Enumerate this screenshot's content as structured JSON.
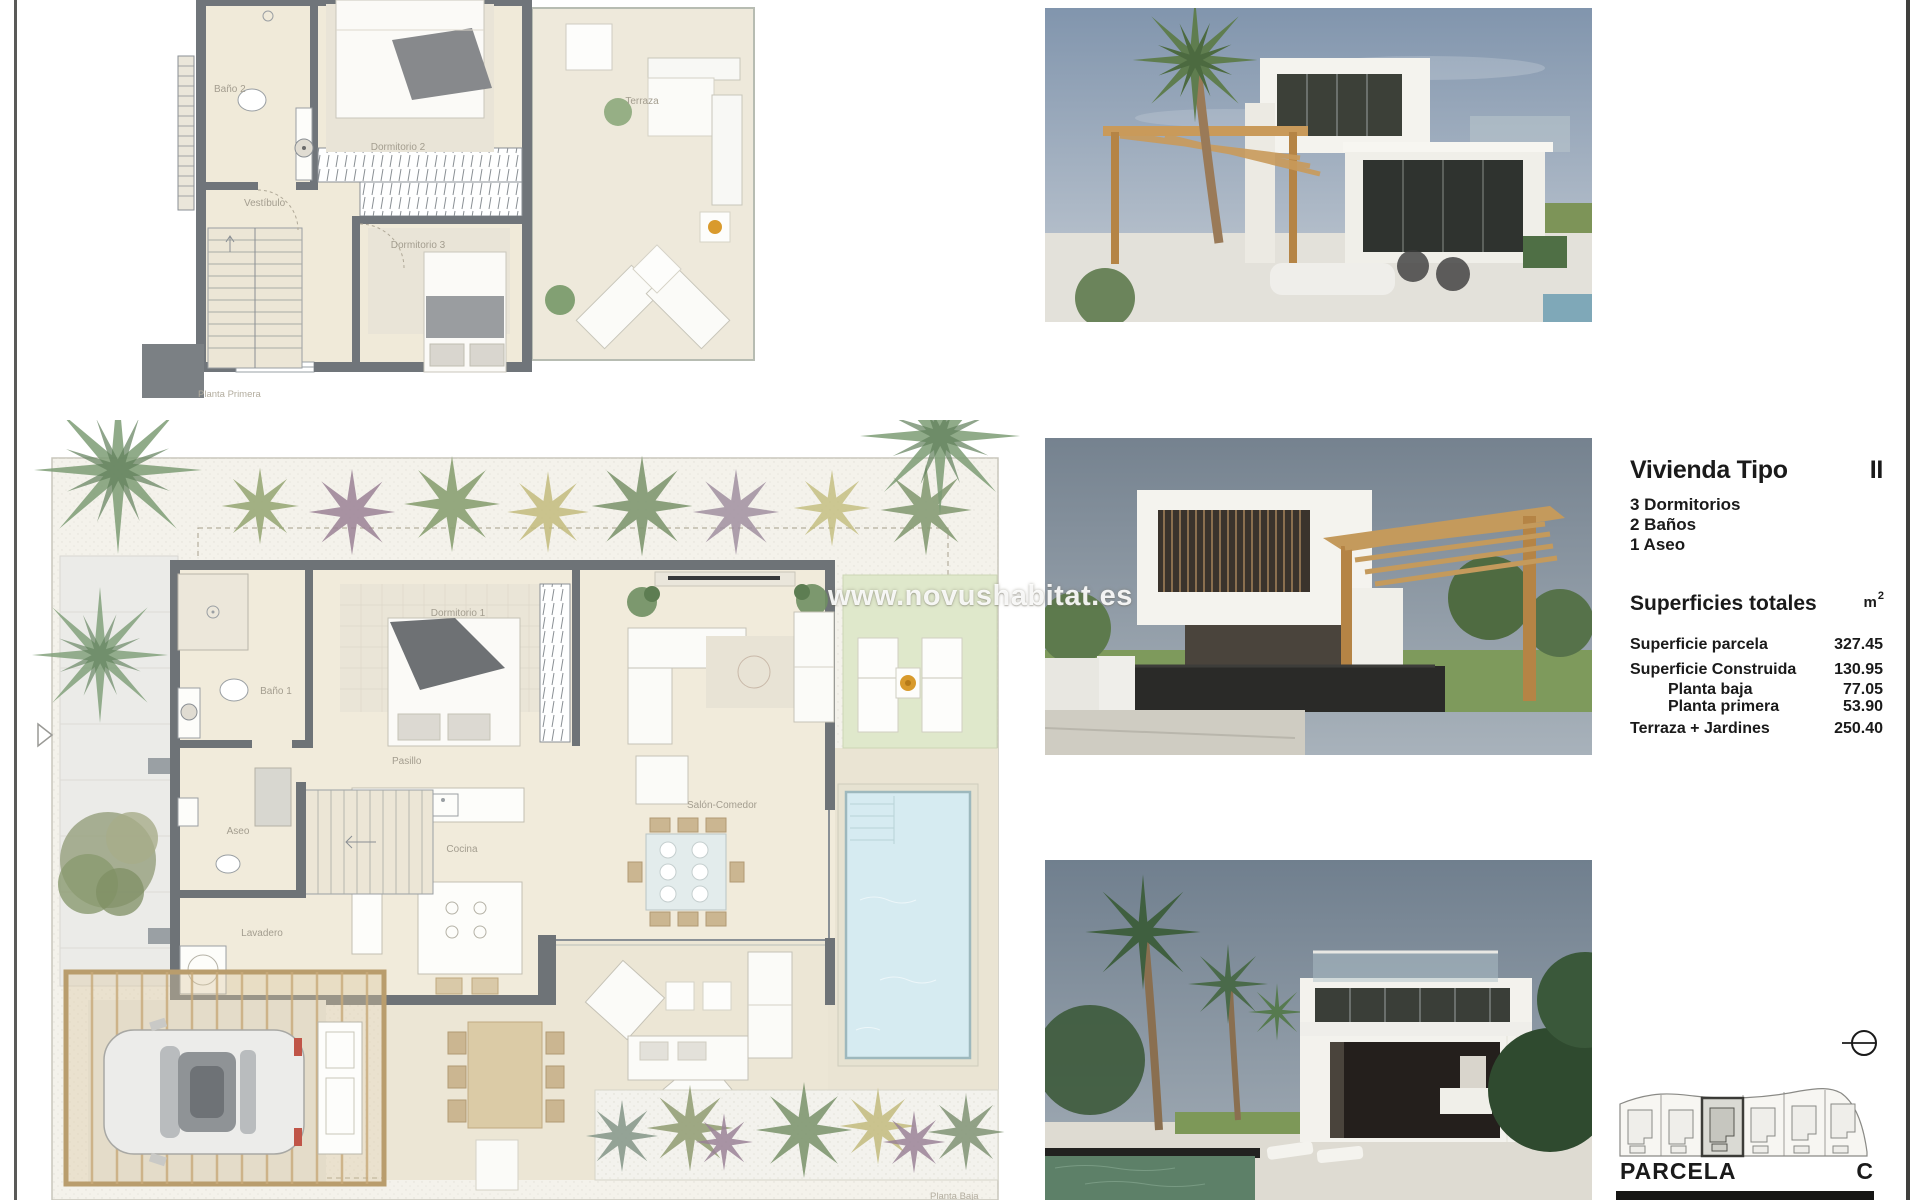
{
  "watermark": "www.novushabitat.es",
  "plan_first": {
    "caption": "Planta Primera",
    "rooms": {
      "bano2": "Baño 2",
      "dorm2": "Dormitorio 2",
      "vestibulo": "Vestíbulo",
      "dorm3": "Dormitorio 3",
      "terraza": "Terraza"
    }
  },
  "plan_ground": {
    "caption": "Planta Baja",
    "rooms": {
      "bano1": "Baño 1",
      "dorm1": "Dormitorio 1",
      "pasillo": "Pasillo",
      "salon": "Salón-Comedor",
      "aseo": "Aseo",
      "cocina": "Cocina",
      "lavadero": "Lavadero"
    }
  },
  "info": {
    "title": "Vivienda Tipo",
    "type": "II",
    "features": [
      "3 Dormitorios",
      "2 Baños",
      "1 Aseo"
    ],
    "surfaces_title": "Superficies totales",
    "unit": "m",
    "unit_sup": "2",
    "rows": [
      {
        "label": "Superficie parcela",
        "value": "327.45"
      },
      {
        "label": "Superficie Construida",
        "value": "130.95"
      },
      {
        "label": "Planta baja",
        "value": "77.05"
      },
      {
        "label": "Planta primera",
        "value": "53.90"
      },
      {
        "label": "Terraza + Jardines",
        "value": "250.40"
      }
    ],
    "parcela_label": "PARCELA",
    "parcela_value": "C"
  },
  "photos": [
    {
      "name": "villa-exterior-render"
    },
    {
      "name": "villa-pergola-render"
    },
    {
      "name": "villa-pool-render"
    }
  ],
  "site_plan": {
    "lots": 6,
    "highlighted_lot": 3
  },
  "colors": {
    "wall": "#6e7377",
    "floor": "#f0ead9",
    "pool": "#d6ebf1",
    "lawn": "#dfe8cb",
    "wood": "#c9a066",
    "accent_dark": "#161614"
  }
}
